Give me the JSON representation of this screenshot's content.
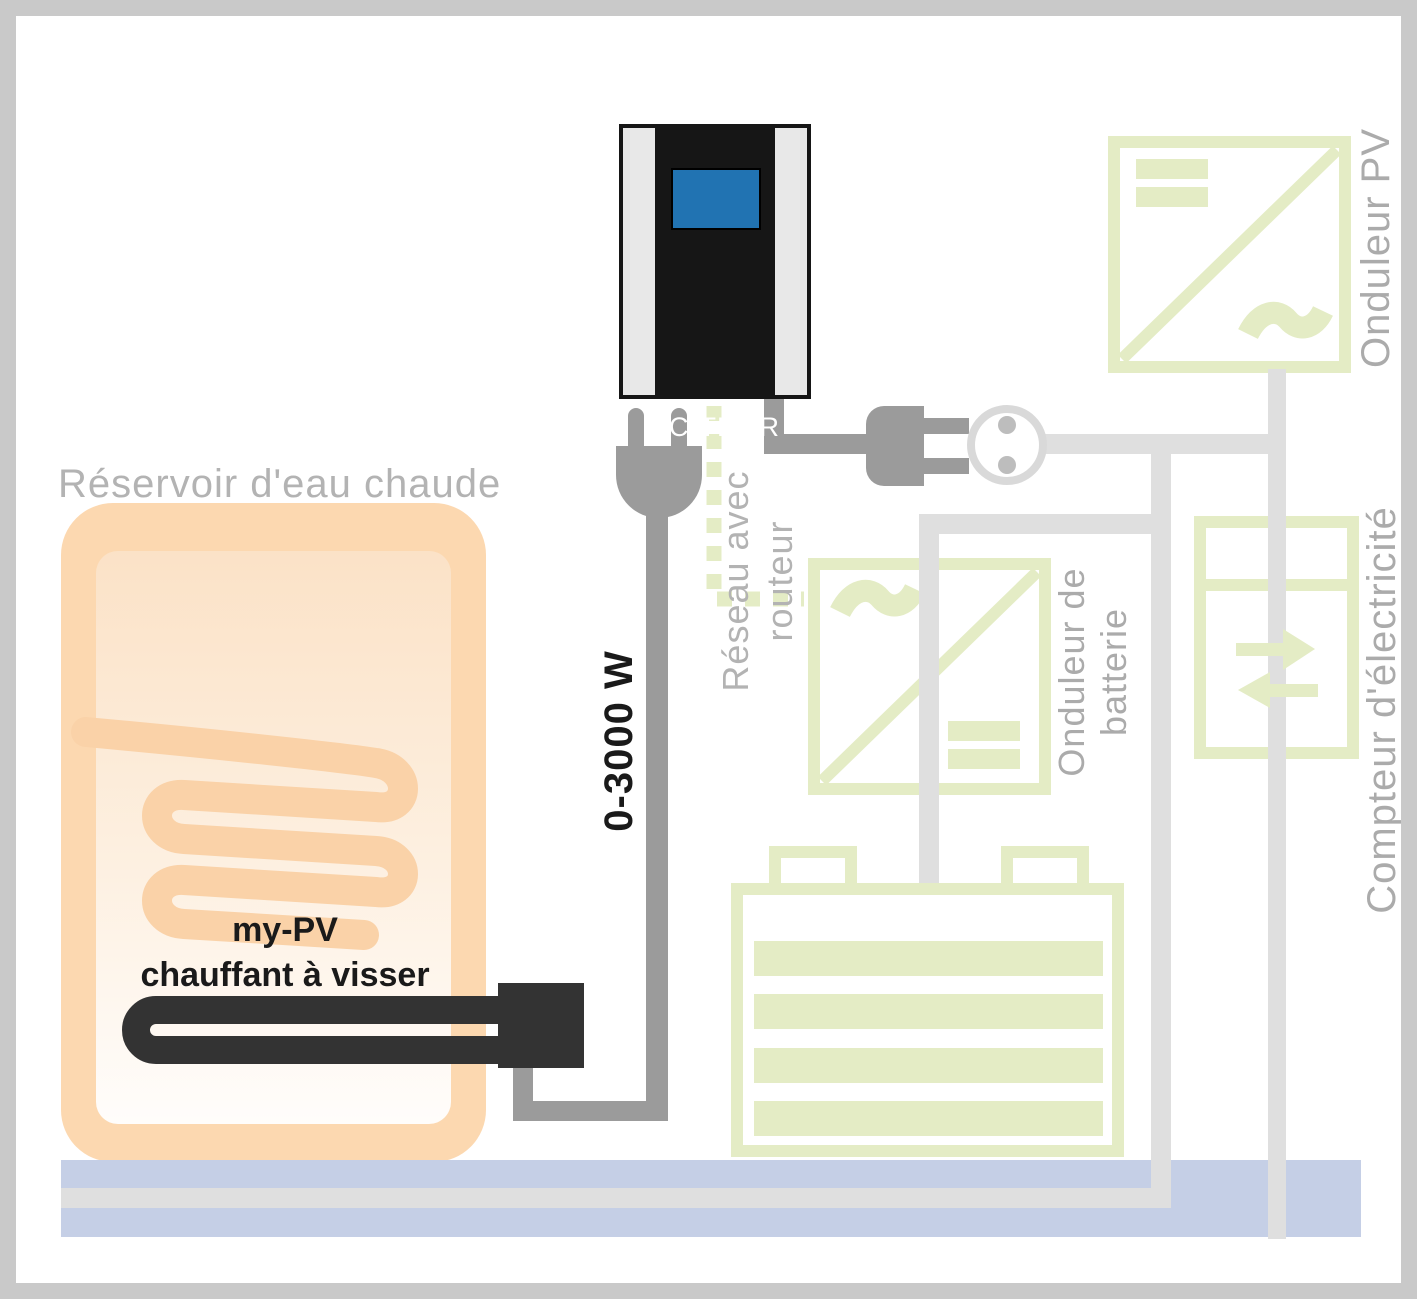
{
  "labels": {
    "acthor": "AC·THOR",
    "tank_title": "Réservoir d'eau chaude",
    "heater_line1": "my-PV",
    "heater_line2": "chauffant à visser",
    "cable_power": "0-3000 W",
    "network_line1": "Réseau avec",
    "network_line2": "routeur",
    "pv_inverter": "Onduleur PV",
    "battery_inverter_line1": "Onduleur de",
    "battery_inverter_line2": "batterie",
    "meter": "Compteur d'électricité"
  },
  "colors": {
    "accent_green": "#e4ecc5",
    "wire_light": "#dfdfdf",
    "wire_medium": "#9b9b9b",
    "component_dark": "#333333",
    "device_black": "#161616",
    "device_stripe": "#e8e8e8",
    "screen_blue": "#2173b2",
    "bus_blue": "#c5cfe6",
    "tank_shell": "#fcd8b0",
    "tank_coil": "#fad2a8",
    "label_gray": "#ababab",
    "text_black": "#1a1a1a",
    "frame_gray": "#c9c9c9",
    "socket_ring": "#d9d9d9",
    "socket_dot": "#bdbdbd"
  }
}
